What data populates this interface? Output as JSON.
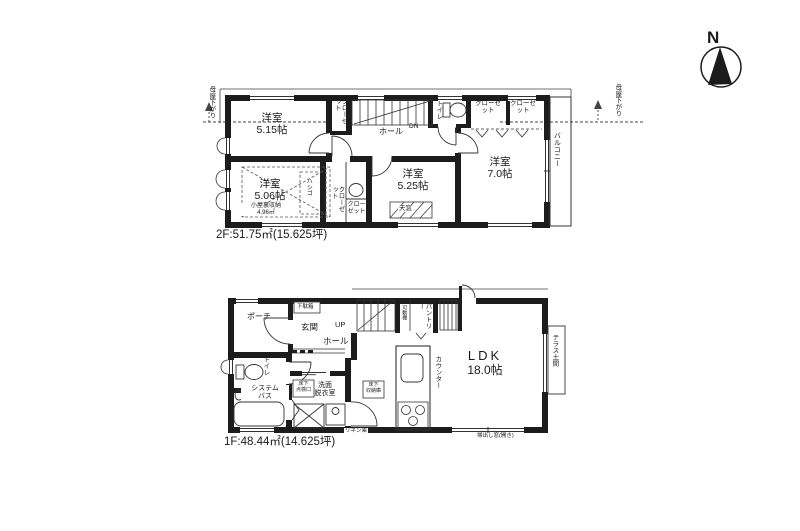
{
  "colors": {
    "wall": "#1c1c1c",
    "line": "#333333",
    "bg": "#ffffff"
  },
  "compass": {
    "label": "N"
  },
  "floor2": {
    "caption": "2F:51.75㎡(15.625坪)",
    "moya_left": "母屋下がり",
    "moya_right": "母屋下がり",
    "room_a_name": "洋室",
    "room_a_size": "5.15帖",
    "room_b_name": "洋室",
    "room_b_size": "5.06帖",
    "attic_label": "小屋裏収納",
    "attic_size": "4.96㎡",
    "ladder": "ハシゴ",
    "closet_top": "クローゼット",
    "closet_mid": "クローゼット",
    "closet_small": "クローゼット",
    "hall": "ホール",
    "dn": "DN",
    "toilet": "トイレ",
    "closet_c": "クローゼット",
    "closet_d": "クローゼット",
    "room_c_name": "洋室",
    "room_c_size": "5.25帖",
    "skylight": "天窓",
    "room_d_name": "洋室",
    "room_d_size": "7.0帖",
    "balcony": "バルコニー"
  },
  "floor1": {
    "caption": "1F:48.44㎡(14.625坪)",
    "porch": "ポーチ",
    "getabako": "下駄箱",
    "genkan": "玄関",
    "hall": "ホール",
    "up": "UP",
    "toilet": "トイレ",
    "bath_line1": "システム",
    "bath_line2": "バス",
    "wash_line1": "洗面",
    "wash_line2": "脱衣室",
    "uf_check_line1": "床下",
    "uf_check_line2": "点検口",
    "uf_store_line1": "床下",
    "uf_store_line2": "収納庫",
    "linen": "リネン庫",
    "pantry": "パントリー",
    "shelf": "可動棚",
    "counter": "カウンター",
    "ldk_name": "LDK",
    "ldk_size": "18.0帖",
    "terrace": "テラス土間",
    "window_note": "掃出し窓(開き)"
  }
}
